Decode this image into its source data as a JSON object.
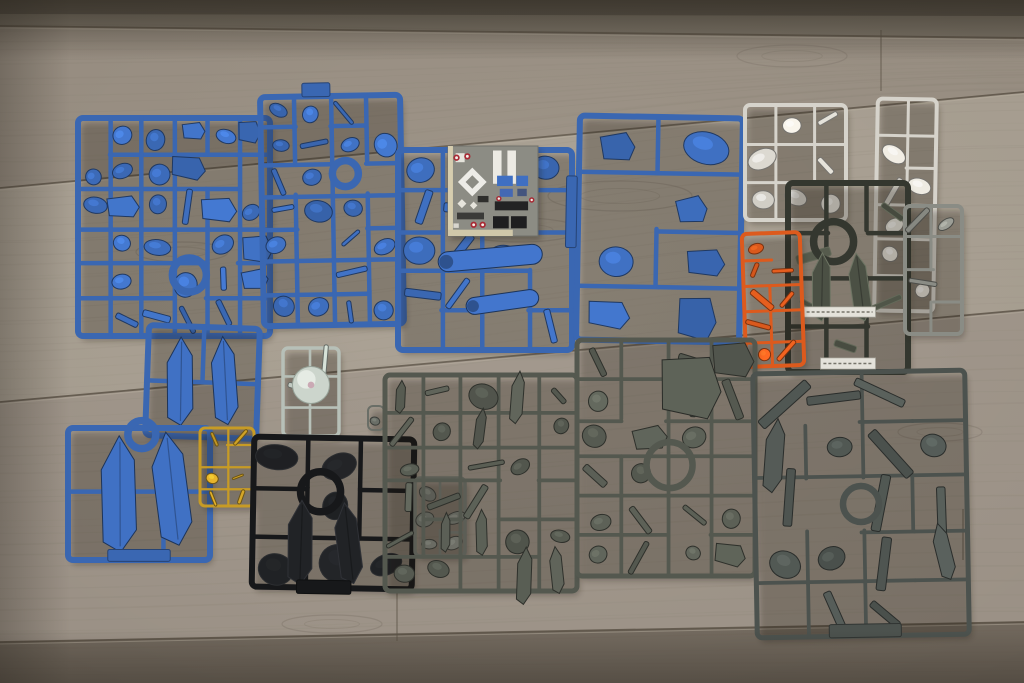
{
  "scene": {
    "type": "photograph",
    "subject": "Plastic model kit runners (sprues) with parts, laid out on a wooden floor",
    "items": [
      "blue sprues",
      "gray sprues",
      "black sprue",
      "dark sprue with label strips",
      "white sprues",
      "orange sprue",
      "gold sprue",
      "clear sprue with dome part",
      "marking sticker sheet"
    ]
  },
  "floor": {
    "base_mid": "#a0978a",
    "planks": [
      {
        "pts": [
          [
            0,
            0
          ],
          [
            1024,
            0
          ],
          [
            1024,
            16
          ],
          [
            0,
            14
          ]
        ],
        "fill": "#46403a",
        "op": 0.8
      },
      {
        "pts": [
          [
            0,
            0
          ],
          [
            1024,
            0
          ],
          [
            1024,
            38
          ],
          [
            0,
            26
          ]
        ],
        "fill": "#5f574c",
        "op": 0.55
      },
      {
        "pts": [
          [
            0,
            26
          ],
          [
            1024,
            38
          ],
          [
            1024,
            92
          ],
          [
            0,
            188
          ]
        ],
        "fill": "#877e72",
        "op": 0.5
      },
      {
        "pts": [
          [
            0,
            188
          ],
          [
            1024,
            92
          ],
          [
            1024,
            310
          ],
          [
            0,
            402
          ]
        ],
        "fill": "#a79e91",
        "op": 0.45
      },
      {
        "pts": [
          [
            0,
            402
          ],
          [
            1024,
            310
          ],
          [
            1024,
            622
          ],
          [
            0,
            642
          ]
        ],
        "fill": "#90887c",
        "op": 0.4
      },
      {
        "pts": [
          [
            0,
            642
          ],
          [
            1024,
            622
          ],
          [
            1024,
            683
          ],
          [
            0,
            683
          ]
        ],
        "fill": "#665d52",
        "op": 0.85
      }
    ],
    "seams": [
      [
        [
          0,
          26
        ],
        [
          1024,
          38
        ]
      ],
      [
        [
          0,
          188
        ],
        [
          1024,
          92
        ]
      ],
      [
        [
          0,
          402
        ],
        [
          1024,
          310
        ]
      ],
      [
        [
          0,
          642
        ],
        [
          1024,
          622
        ]
      ]
    ],
    "seam_color": "#574e42",
    "seam_hl": "#b9b0a0",
    "joints": [
      [
        [
          881,
          30
        ],
        [
          881,
          91
        ]
      ],
      [
        [
          397,
          591
        ],
        [
          397,
          641
        ]
      ],
      [
        [
          963,
          509
        ],
        [
          963,
          560
        ]
      ]
    ],
    "knots": [
      {
        "cx": 620,
        "cy": 196,
        "rx": 72,
        "ry": 15
      },
      {
        "cx": 792,
        "cy": 56,
        "rx": 55,
        "ry": 11
      },
      {
        "cx": 182,
        "cy": 252,
        "rx": 46,
        "ry": 10
      },
      {
        "cx": 332,
        "cy": 624,
        "rx": 50,
        "ry": 9
      },
      {
        "cx": 520,
        "cy": 230,
        "rx": 60,
        "ry": 12
      },
      {
        "cx": 940,
        "cy": 432,
        "rx": 42,
        "ry": 9
      }
    ],
    "grain_color": "#6d6458"
  },
  "sticker_sheet": {
    "x": 448,
    "y": 146,
    "w": 90,
    "h": 90,
    "bg": "#8c8c84",
    "border": "#70706a",
    "decals": [
      {
        "t": "rect",
        "x": 0.0,
        "y": 0.0,
        "w": 0.055,
        "h": 1.0,
        "c": "#d6cdaf"
      },
      {
        "t": "rect",
        "x": 0.0,
        "y": 0.93,
        "w": 0.72,
        "h": 0.07,
        "c": "#d0c7a9"
      },
      {
        "t": "rect",
        "x": 0.5,
        "y": 0.05,
        "w": 0.095,
        "h": 0.37,
        "c": "#eceae3"
      },
      {
        "t": "rect",
        "x": 0.66,
        "y": 0.05,
        "w": 0.095,
        "h": 0.37,
        "c": "#eceae3"
      },
      {
        "t": "rect",
        "x": 0.085,
        "y": 0.08,
        "w": 0.1,
        "h": 0.1,
        "c": "#e6e4dc"
      },
      {
        "t": "diamond",
        "cx": 0.27,
        "cy": 0.4,
        "r": 0.16,
        "c": "#edece7",
        "hole": 0.075
      },
      {
        "t": "diamond",
        "cx": 0.155,
        "cy": 0.64,
        "r": 0.05,
        "c": "#e6e4dc"
      },
      {
        "t": "diamond",
        "cx": 0.285,
        "cy": 0.66,
        "r": 0.042,
        "c": "#e6e4dc"
      },
      {
        "t": "rect",
        "x": 0.545,
        "y": 0.33,
        "w": 0.175,
        "h": 0.115,
        "c": "#3f6fc2"
      },
      {
        "t": "rect",
        "x": 0.76,
        "y": 0.33,
        "w": 0.13,
        "h": 0.115,
        "c": "#3f6fc2"
      },
      {
        "t": "rect",
        "x": 0.575,
        "y": 0.475,
        "w": 0.145,
        "h": 0.09,
        "c": "#4468b4"
      },
      {
        "t": "rect",
        "x": 0.77,
        "y": 0.475,
        "w": 0.105,
        "h": 0.082,
        "c": "#44557e"
      },
      {
        "t": "rect",
        "x": 0.33,
        "y": 0.555,
        "w": 0.12,
        "h": 0.07,
        "c": "#2e2e2c"
      },
      {
        "t": "rect",
        "x": 0.52,
        "y": 0.615,
        "w": 0.37,
        "h": 0.1,
        "c": "#232324"
      },
      {
        "t": "rect",
        "x": 0.5,
        "y": 0.78,
        "w": 0.175,
        "h": 0.135,
        "c": "#1e1e20"
      },
      {
        "t": "rect",
        "x": 0.7,
        "y": 0.78,
        "w": 0.175,
        "h": 0.135,
        "c": "#1e1e20"
      },
      {
        "t": "rect",
        "x": 0.1,
        "y": 0.74,
        "w": 0.3,
        "h": 0.075,
        "c": "#3a3a38"
      },
      {
        "t": "rect",
        "x": 0.06,
        "y": 0.86,
        "w": 0.06,
        "h": 0.05,
        "c": "#d8d6ce"
      },
      {
        "t": "dot",
        "cx": 0.095,
        "cy": 0.13,
        "r": 0.035,
        "c": "#a82a34"
      },
      {
        "t": "dot",
        "cx": 0.215,
        "cy": 0.115,
        "r": 0.035,
        "c": "#a82a34"
      },
      {
        "t": "dot",
        "cx": 0.565,
        "cy": 0.585,
        "r": 0.03,
        "c": "#a82a34"
      },
      {
        "t": "dot",
        "cx": 0.285,
        "cy": 0.875,
        "r": 0.035,
        "c": "#a82a34"
      },
      {
        "t": "dot",
        "cx": 0.385,
        "cy": 0.875,
        "r": 0.035,
        "c": "#a82a34"
      },
      {
        "t": "dot",
        "cx": 0.93,
        "cy": 0.6,
        "r": 0.03,
        "c": "#a82a34"
      }
    ]
  },
  "sprues": [
    {
      "id": "blue-a",
      "x": 78,
      "y": 118,
      "w": 192,
      "h": 218,
      "color": "#3a67b2",
      "fw": 6,
      "rows": 6,
      "cols": 6,
      "density": 0.78,
      "seed": 11,
      "shapes": [
        "blob",
        "blob",
        "plate",
        "rod"
      ],
      "ring": {
        "cx": 0.58,
        "cy": 0.72,
        "r": 17
      }
    },
    {
      "id": "blue-b",
      "x": 262,
      "y": 96,
      "w": 140,
      "h": 229,
      "color": "#3a67b2",
      "fw": 6,
      "rows": 7,
      "cols": 4,
      "density": 0.72,
      "seed": 22,
      "tilt": -1,
      "shapes": [
        "blob",
        "blob",
        "rod"
      ],
      "ring": {
        "cx": 0.6,
        "cy": 0.34,
        "r": 13
      },
      "extras": [
        {
          "t": "tab",
          "x": 0.3,
          "y": -0.058,
          "w": 0.2,
          "h": 0.06
        }
      ]
    },
    {
      "id": "blue-c",
      "x": 398,
      "y": 150,
      "w": 174,
      "h": 200,
      "color": "#3a67b2",
      "fw": 6,
      "rows": 5,
      "cols": 4,
      "density": 0.55,
      "seed": 33,
      "shapes": [
        "blob",
        "rod"
      ],
      "extras": [
        {
          "t": "capsule",
          "cx": 0.53,
          "cy": 0.54,
          "L": 0.6,
          "th": 0.1,
          "rot": -5
        },
        {
          "t": "capsule",
          "cx": 0.6,
          "cy": 0.76,
          "L": 0.42,
          "th": 0.085,
          "rot": -8
        }
      ]
    },
    {
      "id": "sticker-sheet",
      "kind": "sticker"
    },
    {
      "id": "blue-d",
      "x": 578,
      "y": 117,
      "w": 163,
      "h": 224,
      "color": "#3a67b2",
      "fw": 6,
      "rows": 4,
      "cols": 2,
      "density": 0.92,
      "seed": 44,
      "tilt": 1,
      "shapes": [
        "plate",
        "plate",
        "blob"
      ],
      "extras": [
        {
          "t": "tab",
          "x": -0.075,
          "y": 0.27,
          "w": 0.065,
          "h": 0.32
        }
      ]
    },
    {
      "id": "white-a",
      "x": 745,
      "y": 105,
      "w": 101,
      "h": 115,
      "color": "#d6d3cb",
      "fw": 4,
      "rows": 3,
      "cols": 3,
      "density": 0.7,
      "seed": 55,
      "shapes": [
        "blob",
        "rod"
      ]
    },
    {
      "id": "white-b",
      "x": 876,
      "y": 99,
      "w": 59,
      "h": 212,
      "color": "#d6d3cb",
      "fw": 4,
      "rows": 6,
      "cols": 2,
      "density": 0.66,
      "seed": 66,
      "tilt": 1,
      "shapes": [
        "blob",
        "rod"
      ]
    },
    {
      "id": "dark-a",
      "x": 788,
      "y": 183,
      "w": 120,
      "h": 189,
      "color": "#34372f",
      "fw": 6,
      "rows": 4,
      "cols": 3,
      "density": 0.45,
      "seed": 77,
      "shapes": [
        "blob",
        "rod"
      ],
      "ring": {
        "cx": 0.38,
        "cy": 0.31,
        "r": 20
      },
      "extras": [
        {
          "t": "fin",
          "cx": 0.28,
          "cy": 0.55,
          "L": 0.36,
          "w": 0.17,
          "rot": 4
        },
        {
          "t": "fin",
          "cx": 0.6,
          "cy": 0.55,
          "L": 0.36,
          "w": 0.17,
          "rot": -4
        },
        {
          "t": "label",
          "x": 0.13,
          "y": 0.655,
          "w": 0.6,
          "h": 0.055
        },
        {
          "t": "label",
          "x": 0.27,
          "y": 0.925,
          "w": 0.46,
          "h": 0.06
        }
      ]
    },
    {
      "id": "gray-side",
      "x": 905,
      "y": 206,
      "w": 57,
      "h": 128,
      "color": "#8a8c85",
      "fw": 4,
      "rows": 4,
      "cols": 2,
      "density": 0.6,
      "seed": 88,
      "shapes": [
        "blob",
        "rod"
      ]
    },
    {
      "id": "orange",
      "x": 744,
      "y": 233,
      "w": 58,
      "h": 133,
      "color": "#dd5a1d",
      "fw": 4,
      "rows": 5,
      "cols": 2,
      "density": 0.8,
      "seed": 99,
      "tilt": -2,
      "shapes": [
        "blob",
        "rod"
      ]
    },
    {
      "id": "blue-e1",
      "x": 147,
      "y": 327,
      "w": 111,
      "h": 110,
      "color": "#3a67b2",
      "fw": 6,
      "rows": 2,
      "cols": 2,
      "density": 0,
      "seed": 101,
      "tilt": 2,
      "shapes": [
        "blob"
      ],
      "extras": [
        {
          "t": "fin",
          "cx": 0.3,
          "cy": 0.5,
          "L": 0.8,
          "w": 0.26,
          "rot": 2
        },
        {
          "t": "fin",
          "cx": 0.7,
          "cy": 0.48,
          "L": 0.8,
          "w": 0.24,
          "rot": -2
        }
      ]
    },
    {
      "id": "blue-e2",
      "x": 68,
      "y": 428,
      "w": 142,
      "h": 132,
      "color": "#3a67b2",
      "fw": 6,
      "rows": 2,
      "cols": 3,
      "density": 0.15,
      "seed": 102,
      "shapes": [
        "blob"
      ],
      "ring": {
        "cx": 0.52,
        "cy": 0.05,
        "r": 14
      },
      "extras": [
        {
          "t": "fin",
          "cx": 0.36,
          "cy": 0.5,
          "L": 0.88,
          "w": 0.27,
          "rot": 3
        },
        {
          "t": "fin",
          "cx": 0.73,
          "cy": 0.46,
          "L": 0.86,
          "w": 0.26,
          "rot": -3
        },
        {
          "t": "tab",
          "x": 0.28,
          "y": 0.92,
          "w": 0.44,
          "h": 0.09
        }
      ]
    },
    {
      "id": "gold",
      "x": 200,
      "y": 428,
      "w": 54,
      "h": 78,
      "color": "#c79b25",
      "fw": 3,
      "rows": 4,
      "cols": 2,
      "density": 0.95,
      "seed": 103,
      "shapes": [
        "rod",
        "blob"
      ]
    },
    {
      "id": "clear",
      "x": 283,
      "y": 348,
      "w": 56,
      "h": 88,
      "color": "#b7c0b8",
      "fw": 3.5,
      "rows": 3,
      "cols": 2,
      "density": 0.35,
      "seed": 104,
      "shapes": [
        "rod"
      ],
      "extras": [
        {
          "t": "dome",
          "cx": 0.5,
          "cy": 0.42,
          "r": 0.33
        }
      ]
    },
    {
      "id": "black",
      "x": 253,
      "y": 438,
      "w": 160,
      "h": 150,
      "color": "#17181a",
      "fw": 6,
      "rows": 3,
      "cols": 3,
      "density": 0.35,
      "seed": 105,
      "tilt": 1,
      "shapes": [
        "blob"
      ],
      "ring": {
        "cx": 0.42,
        "cy": 0.36,
        "r": 20
      },
      "extras": [
        {
          "t": "fin",
          "cx": 0.3,
          "cy": 0.7,
          "L": 0.56,
          "w": 0.17,
          "rot": 4
        },
        {
          "t": "fin",
          "cx": 0.6,
          "cy": 0.7,
          "L": 0.54,
          "w": 0.16,
          "rot": -4
        },
        {
          "t": "tab",
          "x": 0.28,
          "y": 0.95,
          "w": 0.34,
          "h": 0.09
        }
      ]
    },
    {
      "id": "gray-mini",
      "x": 415,
      "y": 478,
      "w": 50,
      "h": 78,
      "color": "#747871",
      "fw": 3.5,
      "rows": 3,
      "cols": 2,
      "density": 0.7,
      "seed": 106,
      "shapes": [
        "blob",
        "rod"
      ]
    },
    {
      "id": "stray-part",
      "x": 368,
      "y": 406,
      "w": 16,
      "h": 24,
      "color": "#6a6e67",
      "fw": 2,
      "rows": 1,
      "cols": 1,
      "density": 1,
      "seed": 107,
      "shapes": [
        "blob"
      ]
    },
    {
      "id": "gray-g1",
      "x": 385,
      "y": 375,
      "w": 192,
      "h": 216,
      "color": "#54584f",
      "fw": 5,
      "rows": 6,
      "cols": 5,
      "density": 0.82,
      "seed": 108,
      "shapes": [
        "blob",
        "rod",
        "fin"
      ]
    },
    {
      "id": "gray-g2",
      "x": 577,
      "y": 340,
      "w": 178,
      "h": 236,
      "color": "#54584f",
      "fw": 5,
      "rows": 6,
      "cols": 4,
      "density": 0.8,
      "seed": 109,
      "shapes": [
        "blob",
        "rod",
        "plate"
      ],
      "ring": {
        "cx": 0.52,
        "cy": 0.53,
        "r": 23
      },
      "extras": [
        {
          "t": "plate",
          "cx": 0.64,
          "cy": 0.2,
          "W": 0.34,
          "L": 0.26,
          "rot": 3
        }
      ]
    },
    {
      "id": "gray-g3",
      "x": 755,
      "y": 372,
      "w": 212,
      "h": 264,
      "color": "#4c524e",
      "fw": 5,
      "rows": 5,
      "cols": 4,
      "density": 0.72,
      "seed": 110,
      "tilt": -1,
      "shapes": [
        "fin",
        "blob",
        "rod"
      ],
      "ring": {
        "cx": 0.5,
        "cy": 0.5,
        "r": 18
      },
      "extras": [
        {
          "t": "tab",
          "x": 0.34,
          "y": 0.955,
          "w": 0.34,
          "h": 0.05
        }
      ]
    }
  ]
}
